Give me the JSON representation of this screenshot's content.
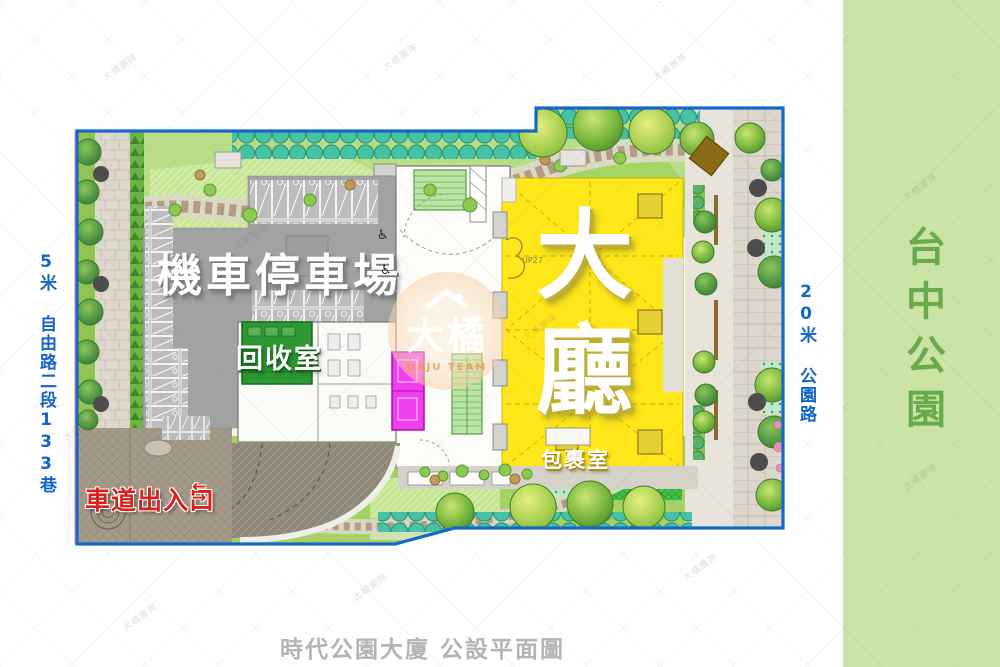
{
  "caption": "時代公園大廈 公設平面圖",
  "park_band": {
    "label": "台中公園"
  },
  "roads": {
    "left_label": "5米 自由路二段133巷",
    "right_label": "20米 公園路"
  },
  "plan": {
    "parking_label": "機車停車場",
    "recycle_label": "回收室",
    "lobby_label": "大廳",
    "package_label": "包裹室",
    "driveway_label": "車道出入口",
    "stair_note": "UP27"
  },
  "icons": {
    "arrow_left": "←",
    "arrow_right": "→",
    "wheelchair": "♿"
  },
  "watermark": {
    "tile_text": "大橘團隊",
    "logo_text": "大橘",
    "logo_subtext": "DAJU TEAM"
  },
  "colors": {
    "boundary_blue": "#1668c8",
    "road_text_blue": "#1565c8",
    "lobby_yellow": "#ffe719",
    "recycle_green": "#2d9733",
    "parking_gray": "#a2a2a2",
    "elevator_magenta": "#ef3def",
    "stair_green": "#b9e6a2",
    "driveway_brown": "#8f8779",
    "driveway_red": "#d8201c",
    "park_band_green": "#cbe3a4",
    "park_text_green": "#69aa4c",
    "caption_gray": "#b4b4b4"
  }
}
